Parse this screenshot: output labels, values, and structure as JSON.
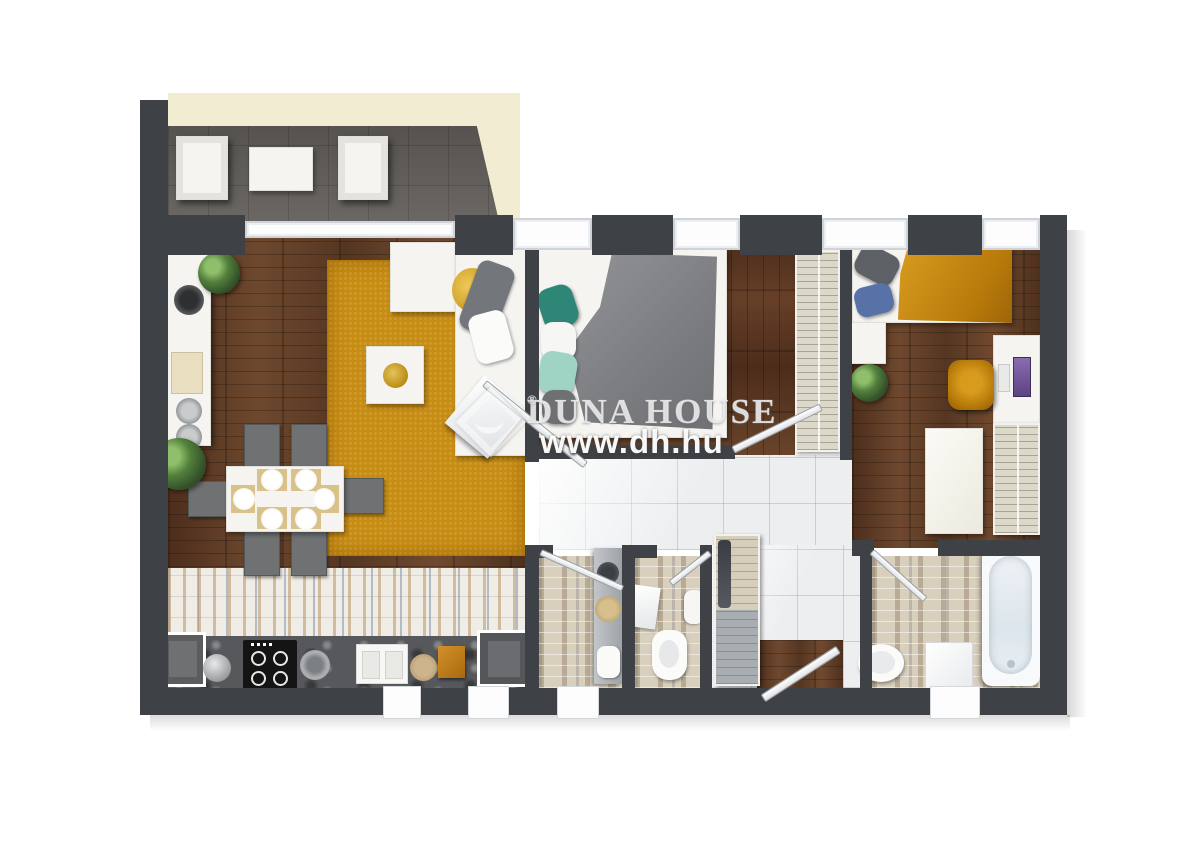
{
  "watermark": {
    "brand": "DUNA HOUSE",
    "registered": "®",
    "url": "www.dh.hu",
    "logo": "diamond-swoosh"
  },
  "palette": {
    "wall": "#3e4146",
    "wood_floor": "#5e3b26",
    "wood_floor_dark": "#4f2f1d",
    "terrace_cream": "#f1ecd2",
    "balcony_tile": "#605c59",
    "rug_mustard": "#c78c12",
    "hall_tile": "#eceef0",
    "bathroom_mosaic": "#d8cfbd",
    "kitchen_mosaic": "#f0ede6",
    "counter_granite": "#57585c",
    "furniture_white": "#f5f4f1",
    "blanket_gray": "#86878a",
    "blanket_mustard": "#c9880e",
    "pillow_teal": "#2e8676",
    "pillow_mint": "#9fd3c4",
    "pillow_blue": "#5872a8",
    "pillow_yellow": "#e0b23c",
    "screen_purple": "#7a5f9e",
    "chair_gray": "#6f7172"
  },
  "floor_plan": {
    "type": "apartment-top-view-3d-render",
    "rooms": [
      {
        "name": "balcony",
        "floor": "dark-tile-on-cream-terrace",
        "furniture": [
          "armchair",
          "coffee-table",
          "armchair"
        ]
      },
      {
        "name": "living-room-kitchen",
        "floor": "wood-plus-mosaic-strip",
        "furniture": [
          "side-counter",
          "plants",
          "mustard-rug",
          "l-shaped-sofa",
          "coffee-table-with-bowl",
          "dining-table-6-settings",
          "6-chairs",
          "stove",
          "sink",
          "kitchen-counter",
          "cabinets"
        ]
      },
      {
        "name": "bedroom-middle",
        "floor": "dark-wood",
        "furniture": [
          "double-bed-gray-blanket",
          "pillows",
          "tall-wardrobe"
        ]
      },
      {
        "name": "bedroom-right",
        "floor": "wood",
        "furniture": [
          "bed-mustard-blanket",
          "nightstand",
          "plant",
          "desk-with-monitor",
          "mustard-chair",
          "table",
          "wardrobe"
        ]
      },
      {
        "name": "hallway",
        "floor": "white-tile",
        "furniture": [
          "coat-closet",
          "entrance-door"
        ]
      },
      {
        "name": "bathroom-middle",
        "floor": "beige-mosaic",
        "furniture": [
          "vanity-with-basins",
          "sink"
        ]
      },
      {
        "name": "wc-middle",
        "floor": "beige-mosaic",
        "furniture": [
          "toilet",
          "towel",
          "small-sink"
        ]
      },
      {
        "name": "bathroom-right",
        "floor": "beige-mosaic",
        "furniture": [
          "bathtub",
          "toilet",
          "washing-machine"
        ]
      }
    ],
    "windows": 8,
    "entrance": "bottom-right-hall"
  }
}
